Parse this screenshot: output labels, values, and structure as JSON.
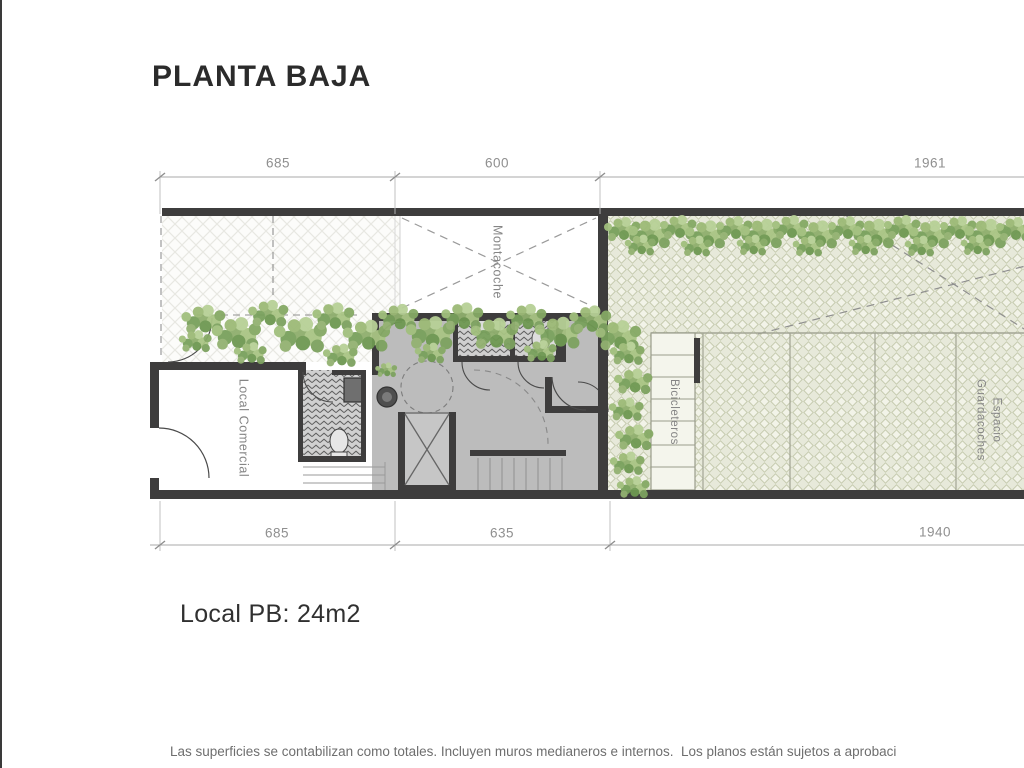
{
  "title": "PLANTA BAJA",
  "plan": {
    "dimensions_top": [
      "685",
      "600",
      "1961"
    ],
    "dimensions_bottom": [
      "685",
      "635",
      "1940"
    ],
    "labels": {
      "montacoche": "Montacoche",
      "local_comercial": "Local Comercial",
      "bicicleteros": "Bicicleteros",
      "espacio_guardacoches": "Espacio\nGuardacoches"
    }
  },
  "area_note": "Local PB: 24m2",
  "footer_disclaimer": "Las superficies se contabilizan como totales. Incluyen muros medianeros e internos.  Los planos están sujetos a aprobaci",
  "colors": {
    "wall": "#3e3d3d",
    "interior_floor": "#bcbcbc",
    "garage_tint": "#e7e9da",
    "plant_green": "#86a968",
    "dimension_gray": "#8f8f8f"
  }
}
